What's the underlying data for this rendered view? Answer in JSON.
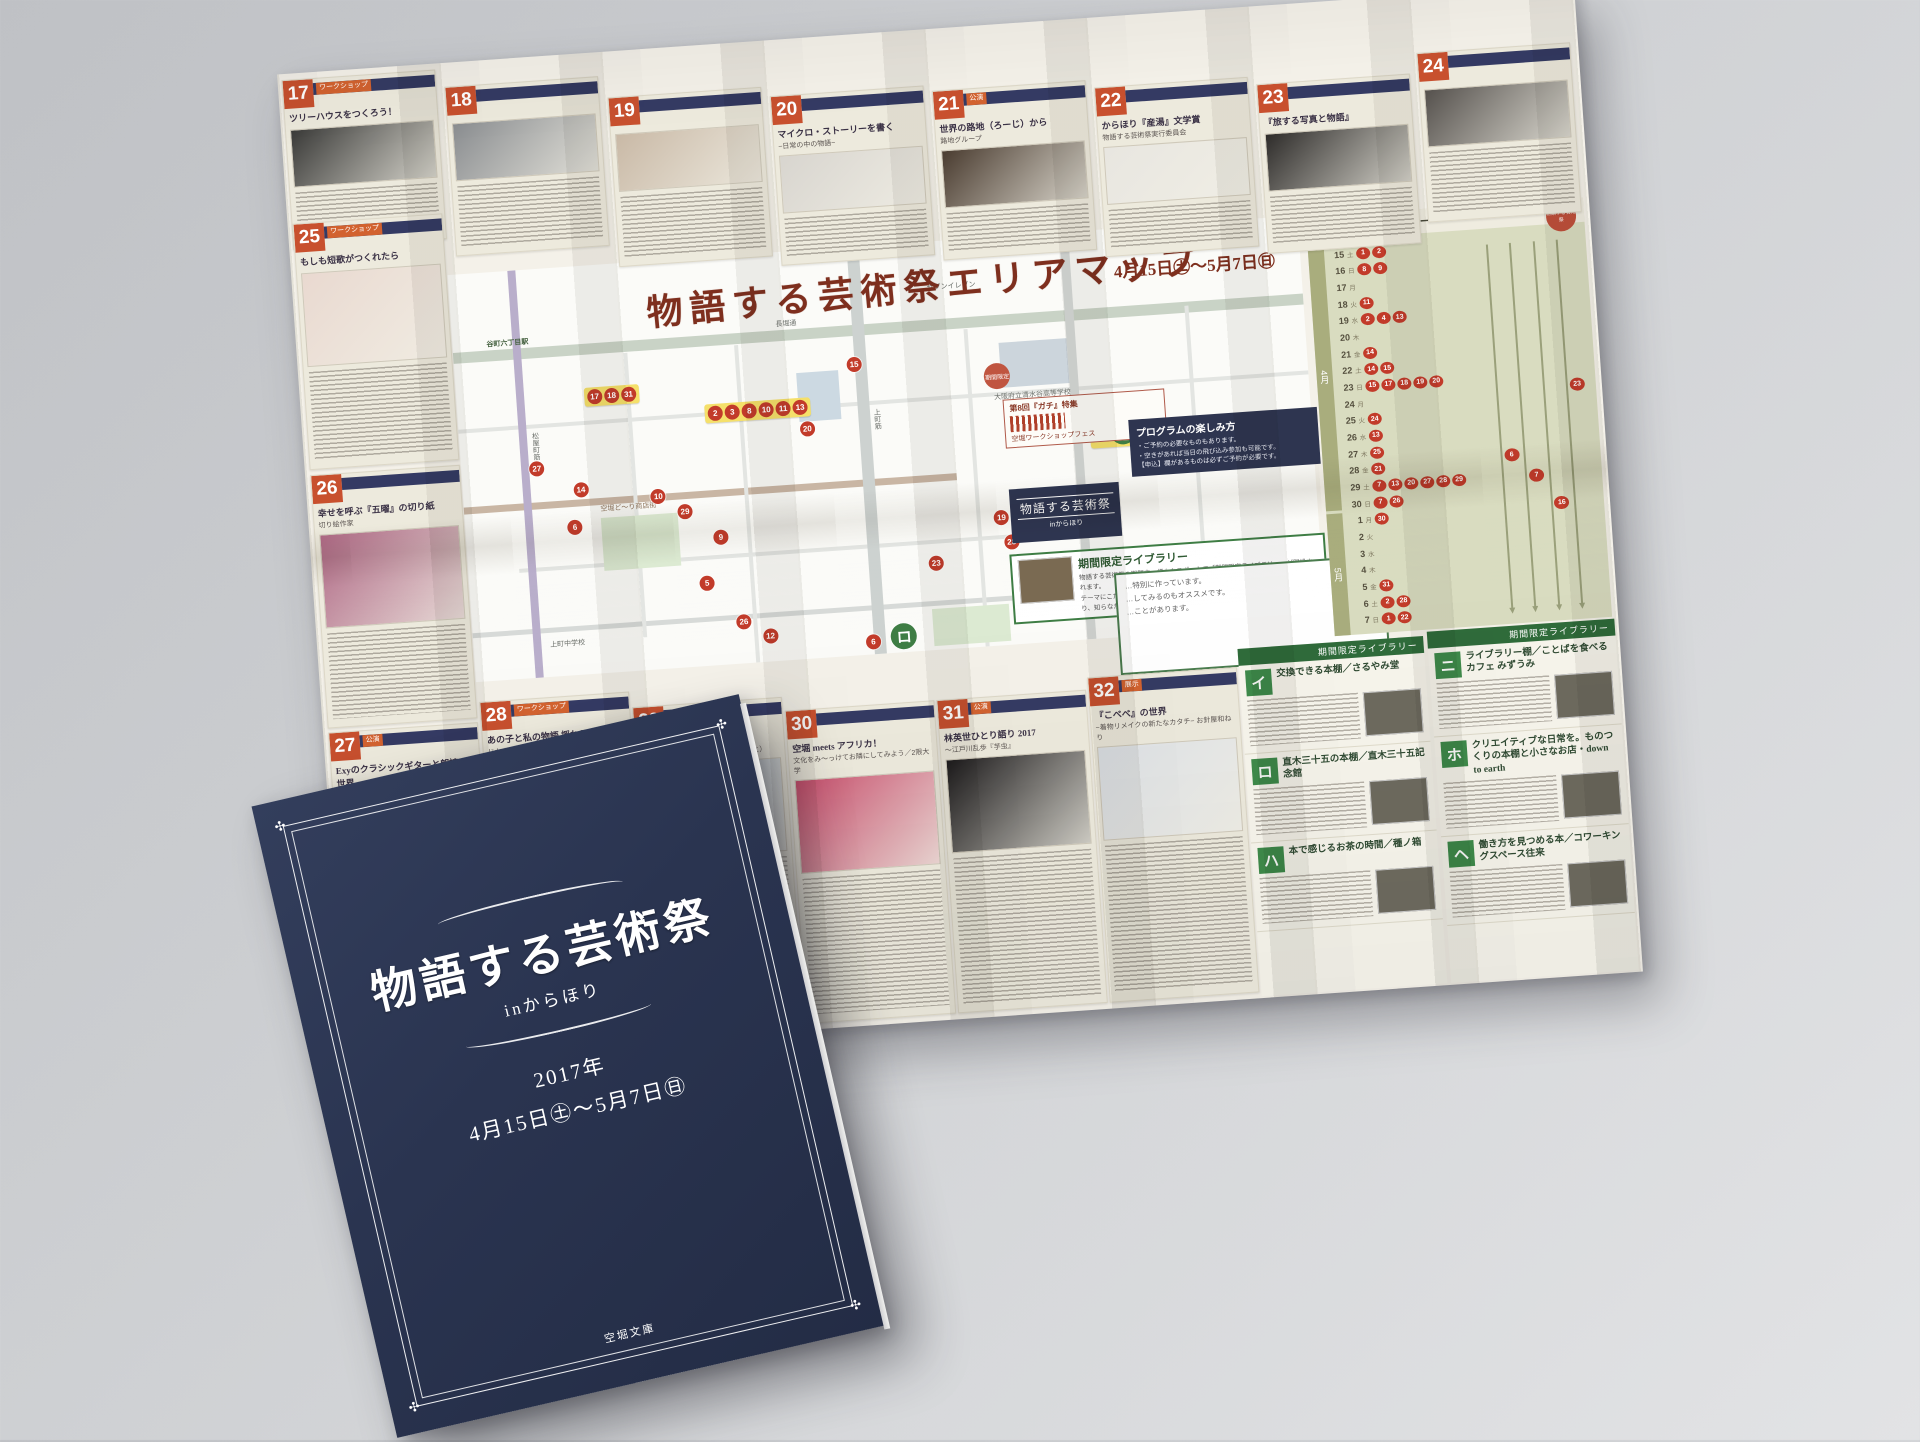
{
  "sheet": {
    "title": "物語する芸術祭エリアマップ",
    "date_year": "2017年",
    "date_range": "4月15日㊏〜5月7日㊐",
    "entries": [
      {
        "num": "17",
        "title": "ツリーハウスをつくろう！",
        "subtitle": "",
        "tag": "ワークショップ",
        "details": []
      },
      {
        "num": "18",
        "title": "",
        "subtitle": "",
        "tag": "",
        "details": []
      },
      {
        "num": "19",
        "title": "",
        "subtitle": "",
        "tag": "",
        "details": []
      },
      {
        "num": "20",
        "title": "マイクロ・ストーリーを書く",
        "subtitle": "−日常の中の物語−",
        "tag": "",
        "details": []
      },
      {
        "num": "21",
        "title": "世界の路地（ろーじ）から",
        "subtitle": "路地グループ",
        "tag": "公演",
        "details": []
      },
      {
        "num": "22",
        "title": "からほり『産湯』文学賞",
        "subtitle": "物語する芸術祭実行委員会",
        "tag": "",
        "details": []
      },
      {
        "num": "23",
        "title": "『旅する写真と物語』",
        "subtitle": "",
        "tag": "",
        "details": []
      },
      {
        "num": "24",
        "title": "",
        "subtitle": "",
        "tag": "",
        "details": []
      },
      {
        "num": "25",
        "title": "もしも短歌がつくれたら",
        "subtitle": "",
        "tag": "ワークショップ",
        "details": []
      },
      {
        "num": "26",
        "title": "幸せを呼ぶ『五曜』の切り紙",
        "subtitle": "切り絵作家",
        "tag": "",
        "details": []
      },
      {
        "num": "27",
        "title": "Exyのクラシックギターと朗読の世界",
        "subtitle": "",
        "tag": "公演",
        "details": []
      },
      {
        "num": "28",
        "title": "あの子と私の物語 揺れるスカート",
        "subtitle": "じかんせれぶ",
        "tag": "ワークショップ",
        "details": [
          "【会場】アトリエ秘密基地",
          "【日時】4/29（土）14:00〜17:00／5/6（土）14:00〜17:00",
          "【料金】8,000円（材料費込み）",
          "【定員】各4名",
          "【申込】メール／jikanseleb@gmail.com"
        ]
      },
      {
        "num": "29",
        "title": "ひょうたんの踊り場",
        "subtitle": "ずぶとしぶ（赤松みさき・中西ちさと）",
        "tag": "",
        "details": [
          "【料金】1,500円",
          "【定員】15名",
          "【申込】web／https://www.quartet-online…"
        ]
      },
      {
        "num": "30",
        "title": "空堀 meets アフリカ！",
        "subtitle": "文化をみ〜っけてお隣にしてみよう／2限大学",
        "tag": "",
        "details": []
      },
      {
        "num": "31",
        "title": "林英世ひとり語り 2017",
        "subtitle": "〜江戸川乱歩『芋虫』",
        "tag": "公演",
        "details": []
      },
      {
        "num": "32",
        "title": "『こべべ』の世界",
        "subtitle": "−着物リメイクの新たなカタチ− お針屋和ねり",
        "tag": "展示",
        "details": []
      }
    ],
    "map": {
      "labels": {
        "station": "谷町六丁目駅",
        "street_main": "長堀通",
        "street_uemachi": "上町筋",
        "street_matsuya": "松屋町筋",
        "shopping_street": "空堀ど〜り商店街",
        "school": "大阪府立清水谷高等学校",
        "conv_store": "セブンイレブン",
        "junior_high": "上町中学校"
      },
      "notice": {
        "pin": "期間限定",
        "title": "第8回『ガチ』特集",
        "sub": "空堀ワークショップフェス"
      },
      "logo": {
        "title": "物語する芸術祭",
        "sub": "inからほり"
      },
      "info_box": {
        "title": "プログラムの楽しみ方",
        "lines": [
          "・ご予約の必要なものもあります。",
          "・空きがあれば当日の飛び込み参加も可能です。",
          "【申込】欄があるものは必ずご予約が必要です。"
        ]
      },
      "library_box": {
        "title": "期間限定ライブラリー",
        "lines": [
          "物語する芸術祭の期間中、様々なスポットで「期間限定ライブラリー」が開設されます。",
          "テーマにこだわって本をセレクトをしたおすすめの棚です。通りがかりで手に取り、知らなかった世界を覗いてみるのもおすすめです。"
        ]
      },
      "bubble_lines": [
        "…特別に作っています。",
        "…してみるのもオススメです。",
        "…ことがあります。"
      ],
      "marker_groups": [
        {
          "labels": [
            "17",
            "18",
            "31"
          ],
          "x": 15,
          "y": 30
        },
        {
          "labels": [
            "2",
            "3",
            "8",
            "10",
            "11",
            "13"
          ],
          "x": 29,
          "y": 36
        },
        {
          "labels": [
            "12",
            "イ"
          ],
          "x": 66,
          "y": 66
        },
        {
          "labels": [
            "1",
            "ハ"
          ],
          "x": 74,
          "y": 46
        }
      ],
      "markers": [
        {
          "label": "27",
          "x": 8,
          "y": 47,
          "kana": false
        },
        {
          "label": "14",
          "x": 13,
          "y": 53,
          "kana": false
        },
        {
          "label": "10",
          "x": 22,
          "y": 56,
          "kana": false
        },
        {
          "label": "29",
          "x": 25,
          "y": 60,
          "kana": false
        },
        {
          "label": "9",
          "x": 29,
          "y": 67,
          "kana": false
        },
        {
          "label": "5",
          "x": 27,
          "y": 78,
          "kana": false
        },
        {
          "label": "6",
          "x": 12,
          "y": 62,
          "kana": false
        },
        {
          "label": "26",
          "x": 31,
          "y": 88,
          "kana": false
        },
        {
          "label": "12",
          "x": 34,
          "y": 92,
          "kana": false
        },
        {
          "label": "15",
          "x": 46,
          "y": 27,
          "kana": false
        },
        {
          "label": "20",
          "x": 40,
          "y": 42,
          "kana": false
        },
        {
          "label": "23",
          "x": 54,
          "y": 77,
          "kana": false
        },
        {
          "label": "19",
          "x": 62,
          "y": 67,
          "kana": false
        },
        {
          "label": "28",
          "x": 63,
          "y": 73,
          "kana": false
        },
        {
          "label": "6",
          "x": 46,
          "y": 95,
          "kana": false
        },
        {
          "label": "ロ",
          "x": 49,
          "y": 93,
          "kana": true
        }
      ]
    },
    "calendar": {
      "title": "プログラムカレンダー",
      "stamp": "物語する芸術祭",
      "april_label": "4月",
      "may_label": "5月",
      "april": [
        {
          "d": "15",
          "w": "土",
          "e": [
            "1",
            "2"
          ]
        },
        {
          "d": "16",
          "w": "日",
          "e": [
            "8",
            "9"
          ]
        },
        {
          "d": "17",
          "w": "月",
          "e": []
        },
        {
          "d": "18",
          "w": "火",
          "e": [
            "11"
          ]
        },
        {
          "d": "19",
          "w": "水",
          "e": [
            "2",
            "4",
            "13"
          ]
        },
        {
          "d": "20",
          "w": "木",
          "e": []
        },
        {
          "d": "21",
          "w": "金",
          "e": [
            "14"
          ]
        },
        {
          "d": "22",
          "w": "土",
          "e": [
            "14",
            "15"
          ]
        },
        {
          "d": "23",
          "w": "日",
          "e": [
            "15",
            "17",
            "18",
            "19",
            "20"
          ]
        },
        {
          "d": "24",
          "w": "月",
          "e": []
        },
        {
          "d": "25",
          "w": "火",
          "e": [
            "24"
          ]
        },
        {
          "d": "26",
          "w": "水",
          "e": [
            "13"
          ]
        },
        {
          "d": "27",
          "w": "木",
          "e": [
            "25"
          ]
        },
        {
          "d": "28",
          "w": "金",
          "e": [
            "21"
          ]
        },
        {
          "d": "29",
          "w": "土",
          "e": [
            "7",
            "13",
            "20",
            "27",
            "28",
            "29"
          ]
        },
        {
          "d": "30",
          "w": "日",
          "e": [
            "7",
            "26"
          ]
        }
      ],
      "may": [
        {
          "d": "1",
          "w": "月",
          "e": [
            "30"
          ]
        },
        {
          "d": "2",
          "w": "火",
          "e": []
        },
        {
          "d": "3",
          "w": "水",
          "e": []
        },
        {
          "d": "4",
          "w": "木",
          "e": []
        },
        {
          "d": "5",
          "w": "金",
          "e": [
            "31"
          ]
        },
        {
          "d": "6",
          "w": "土",
          "e": [
            "2",
            "28"
          ]
        },
        {
          "d": "7",
          "w": "日",
          "e": [
            "1",
            "22"
          ]
        }
      ],
      "line_markers": [
        "6",
        "7",
        "16",
        "23"
      ]
    },
    "library": {
      "header": "期間限定ライブラリー",
      "items": [
        {
          "kana": "イ",
          "title": "交換できる本棚／さるやみ堂"
        },
        {
          "kana": "ロ",
          "title": "直木三十五の本棚／直木三十五記念館"
        },
        {
          "kana": "ハ",
          "title": "本で感じるお茶の時間／種ノ箱"
        },
        {
          "kana": "ニ",
          "title": "ライブラリー棚／ことばを食べるカフェ みずうみ"
        },
        {
          "kana": "ホ",
          "title": "クリエイティブな日常を。ものつくりの本棚と小さなお店・down to earth"
        },
        {
          "kana": "ヘ",
          "title": "働き方を見つめる本／コワーキングスペース往来"
        }
      ]
    }
  },
  "booklet": {
    "title": "物語する芸術祭",
    "subtitle": "inからほり",
    "year": "2017年",
    "dates": "4月15日㊏〜5月7日㊐",
    "footer": "空堀文庫",
    "cover_color": "#2a3450"
  },
  "colors": {
    "entry_number": "#c8502e",
    "title_bar": "#343a63",
    "marker_red": "#c23b2a",
    "kana_green": "#3e8a4a",
    "calendar_bg": "#d9dcc0",
    "map_title": "#7e2f1e",
    "paper": "#f4f1e9"
  }
}
